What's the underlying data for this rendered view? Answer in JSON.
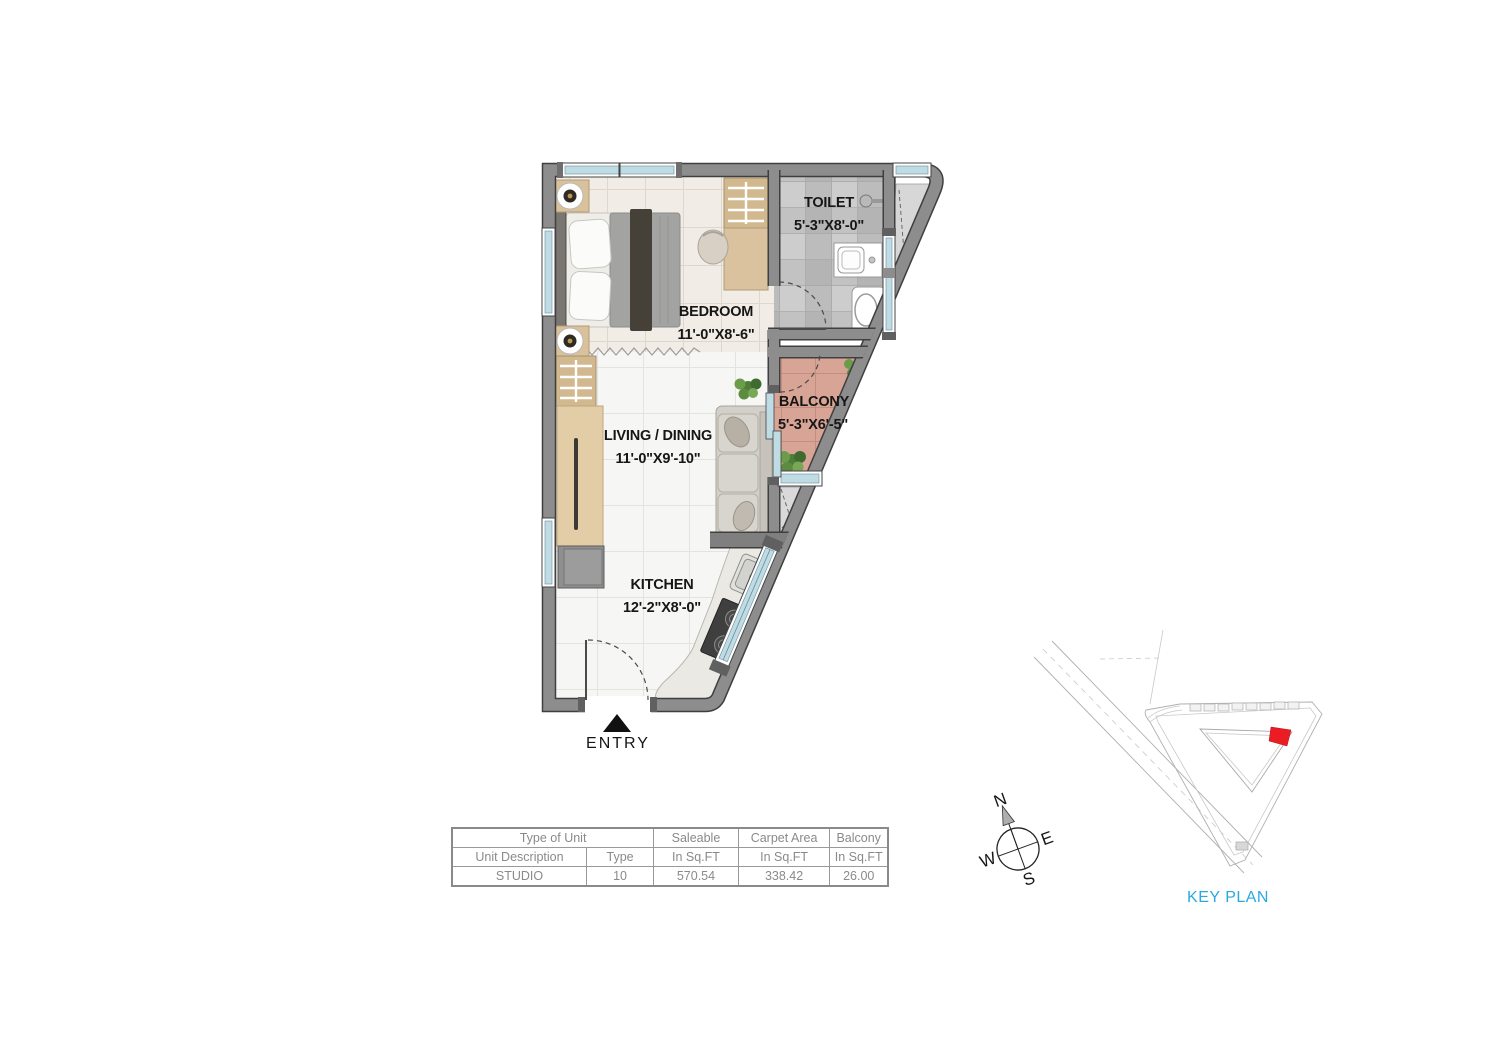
{
  "plan": {
    "rooms": [
      {
        "name": "TOILET",
        "dims": "5'-3\"X8'-0\""
      },
      {
        "name": "BEDROOM",
        "dims": "11'-0\"X8'-6\""
      },
      {
        "name": "BALCONY",
        "dims": "5'-3\"X6'-5\""
      },
      {
        "name": "LIVING / DINING",
        "dims": "11'-0\"X9'-10\""
      },
      {
        "name": "KITCHEN",
        "dims": "12'-2\"X8'-0\""
      }
    ],
    "entry_label": "ENTRY"
  },
  "unit_table": {
    "header_row": {
      "type_of_unit": "Type of Unit",
      "saleable": "Saleable",
      "carpet_area": "Carpet Area",
      "balcony": "Balcony"
    },
    "subheader_row": {
      "unit_description": "Unit Description",
      "type": "Type",
      "in_sqft_1": "In Sq.FT",
      "in_sqft_2": "In Sq.FT",
      "in_sqft_3": "In Sq.FT"
    },
    "data_row": {
      "unit_description": "STUDIO",
      "type": "10",
      "saleable": "570.54",
      "carpet_area": "338.42",
      "balcony": "26.00"
    }
  },
  "compass": {
    "north": "N",
    "east": "E",
    "south": "S",
    "west": "W"
  },
  "key_plan": {
    "label": "KEY PLAN"
  },
  "colors": {
    "wall_gray": "#8d8d8d",
    "balcony_tile": "#d8a495",
    "keyplan_accent": "#29a9e0",
    "unit_marker_red": "#ec1c24",
    "window_glass": "#bfdbe4"
  }
}
